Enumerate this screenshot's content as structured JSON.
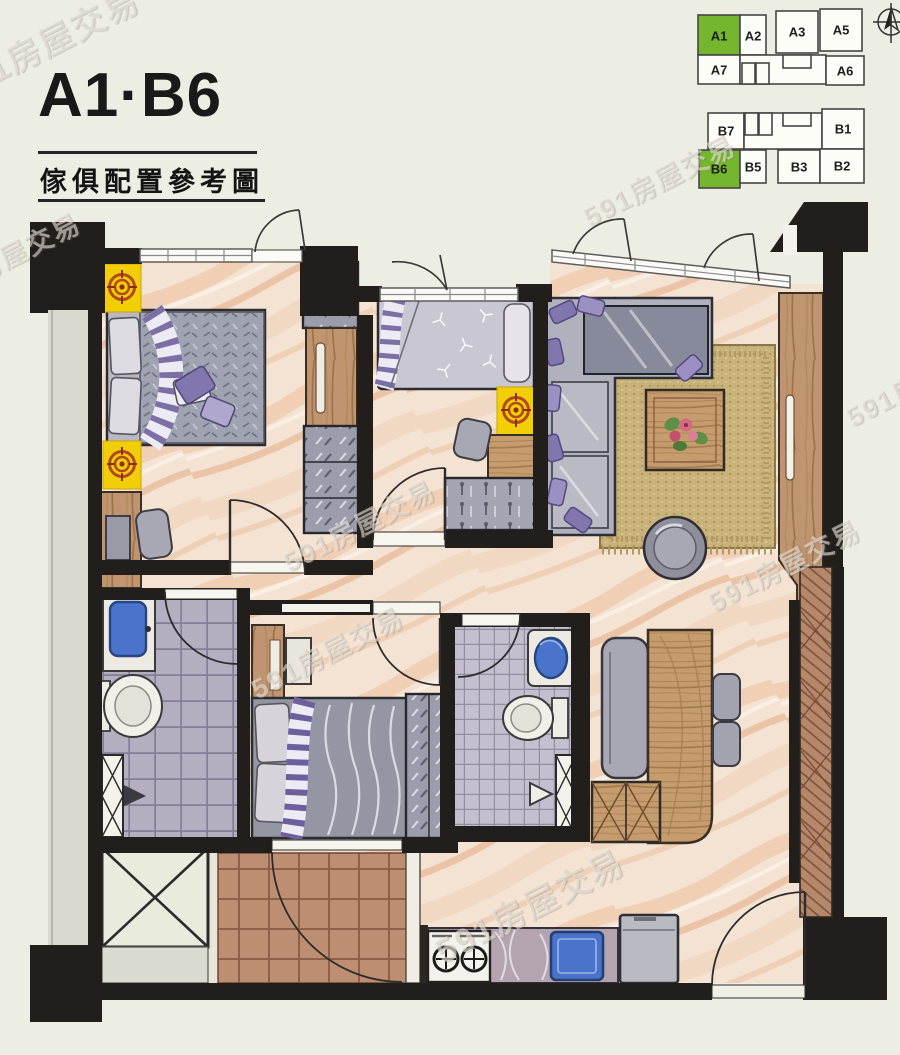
{
  "header": {
    "title": "A1·B6",
    "subtitle": "傢俱配置參考圖"
  },
  "key_plan": {
    "highlight_color": "#74b62e",
    "buildings": [
      {
        "id": "A",
        "units": [
          {
            "label": "A1",
            "highlighted": true
          },
          {
            "label": "A2",
            "highlighted": false
          },
          {
            "label": "A3",
            "highlighted": false
          },
          {
            "label": "A5",
            "highlighted": false
          },
          {
            "label": "A7",
            "highlighted": false
          },
          {
            "label": "A6",
            "highlighted": false
          }
        ]
      },
      {
        "id": "B",
        "units": [
          {
            "label": "B7",
            "highlighted": false
          },
          {
            "label": "B1",
            "highlighted": false
          },
          {
            "label": "B6",
            "highlighted": true
          },
          {
            "label": "B5",
            "highlighted": false
          },
          {
            "label": "B3",
            "highlighted": false
          },
          {
            "label": "B2",
            "highlighted": false
          }
        ]
      }
    ]
  },
  "watermark": {
    "text": "591房屋交易"
  },
  "colors": {
    "highlight_green": "#74b62e",
    "wall": "#211e1b",
    "floor": "#f4e3d2",
    "accent_yellow": "#f2ce06",
    "accent_purple": "#8276ae",
    "wood": "#c69b6d",
    "sink_blue": "#4a73cc"
  }
}
